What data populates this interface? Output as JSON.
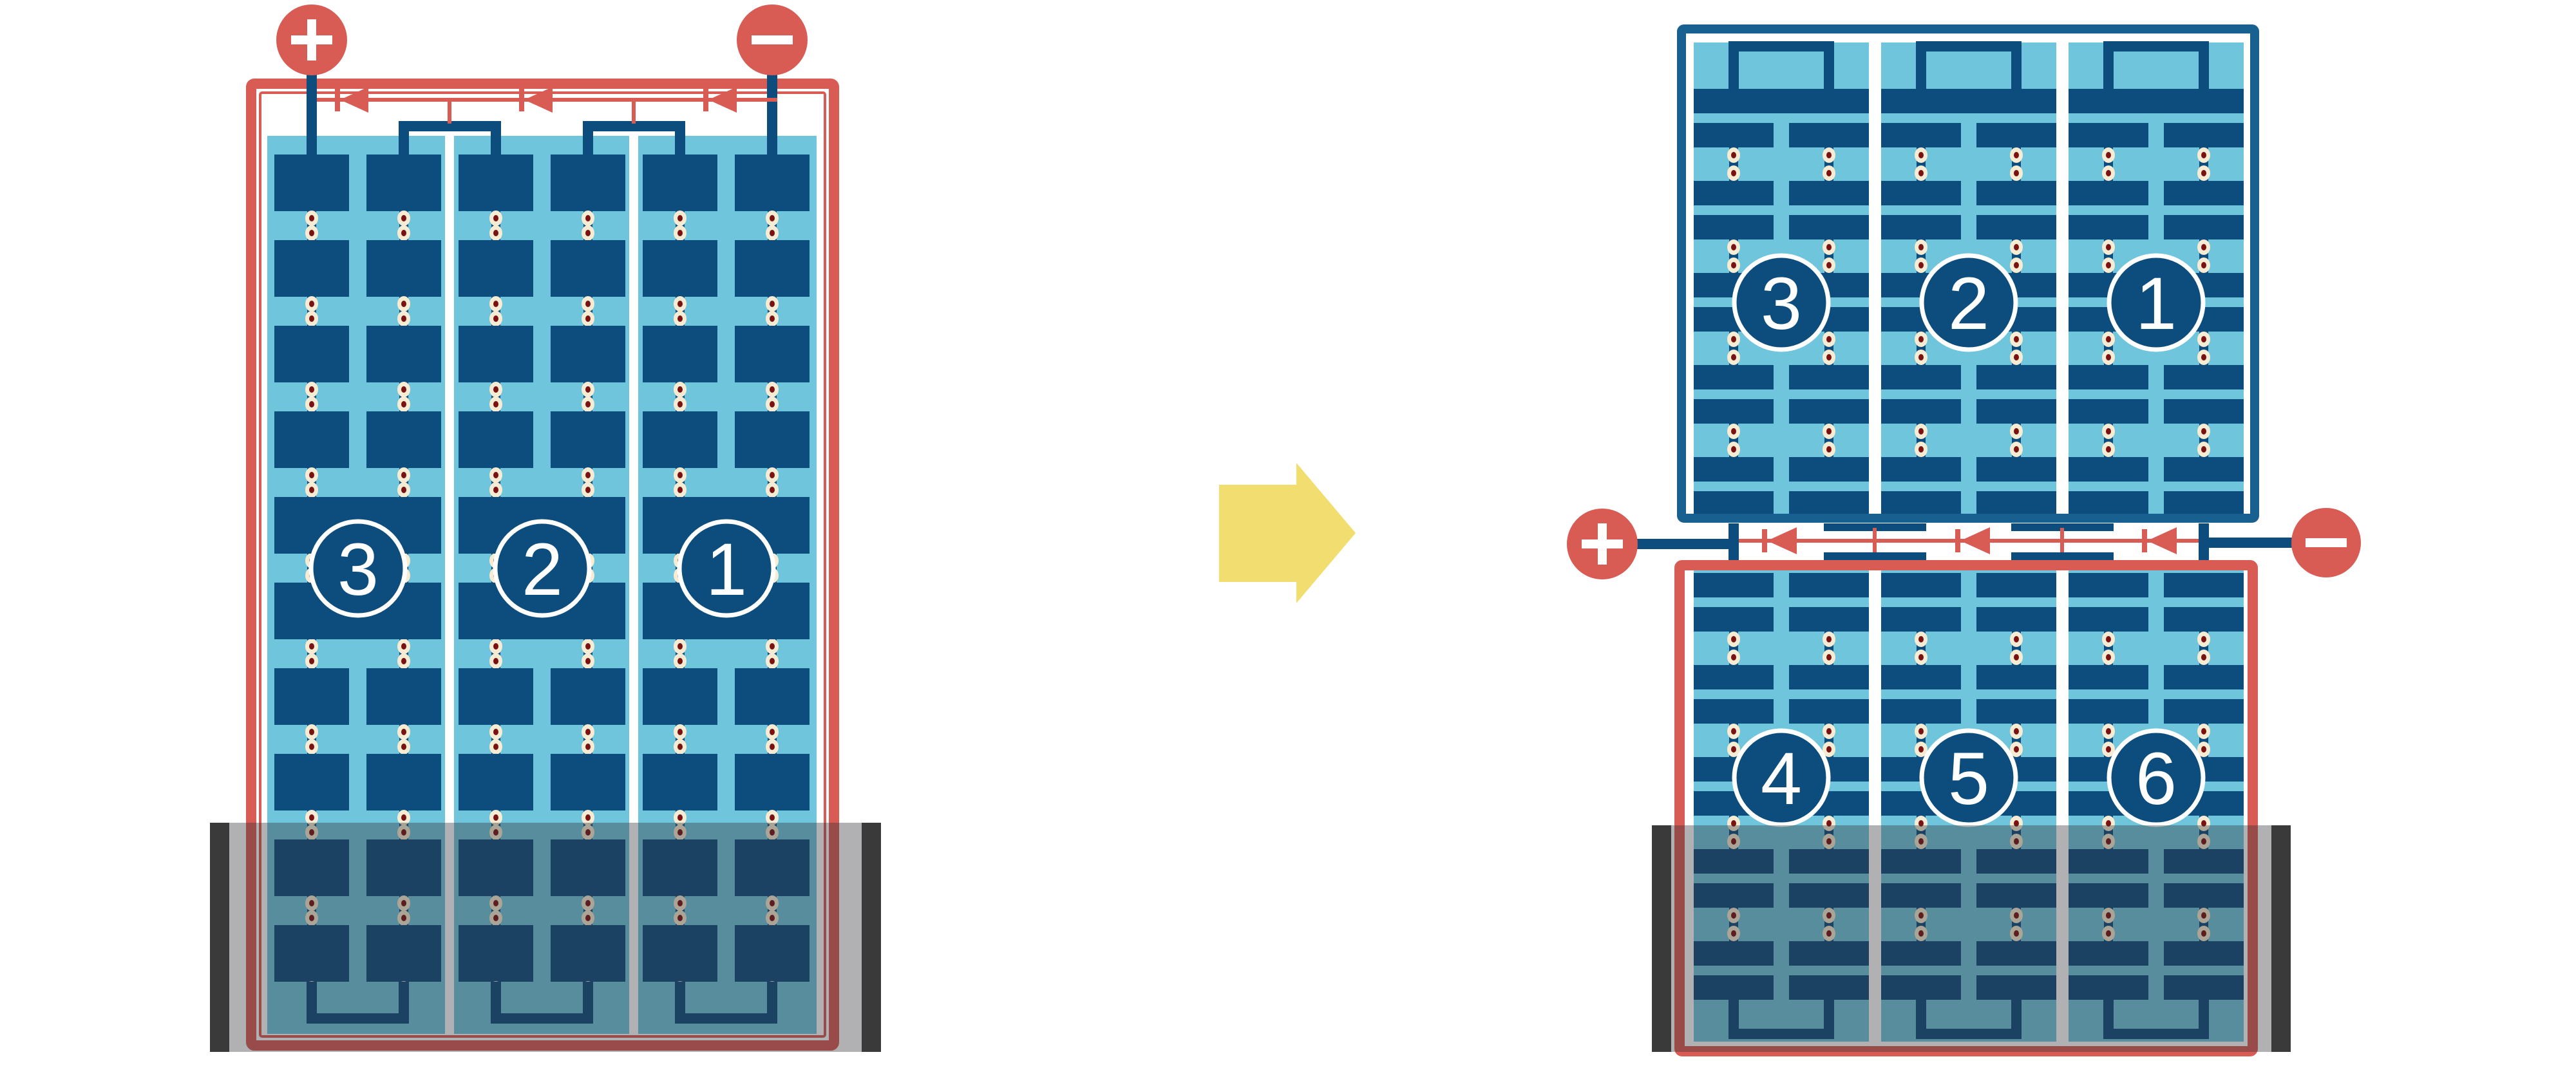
{
  "title": "solar-module-bypass-diode-comparison",
  "colors": {
    "red": "#D85B54",
    "navy": "#0D4D7D",
    "panel": "#6FC5DB",
    "frame": "#17608F",
    "cream": "#F6ECD4",
    "dotred": "#7A1212",
    "yellow": "#F2DE6E",
    "flood": "rgba(50,50,56,0.38)",
    "cap": "#3A3A3A",
    "white": "#FFFFFF"
  },
  "left_module": {
    "labels": [
      "3",
      "2",
      "1"
    ],
    "positive_sign": "+",
    "negative_sign": "−",
    "string_count": 3,
    "bypass_diode_count": 3
  },
  "right_top_module": {
    "labels": [
      "3",
      "2",
      "1"
    ],
    "string_count": 3
  },
  "right_bottom_module": {
    "labels": [
      "4",
      "5",
      "6"
    ],
    "string_count": 3
  },
  "junction": {
    "positive_sign": "+",
    "negative_sign": "−",
    "bypass_diode_count": 3
  },
  "transform_arrow": {
    "direction": "right"
  }
}
